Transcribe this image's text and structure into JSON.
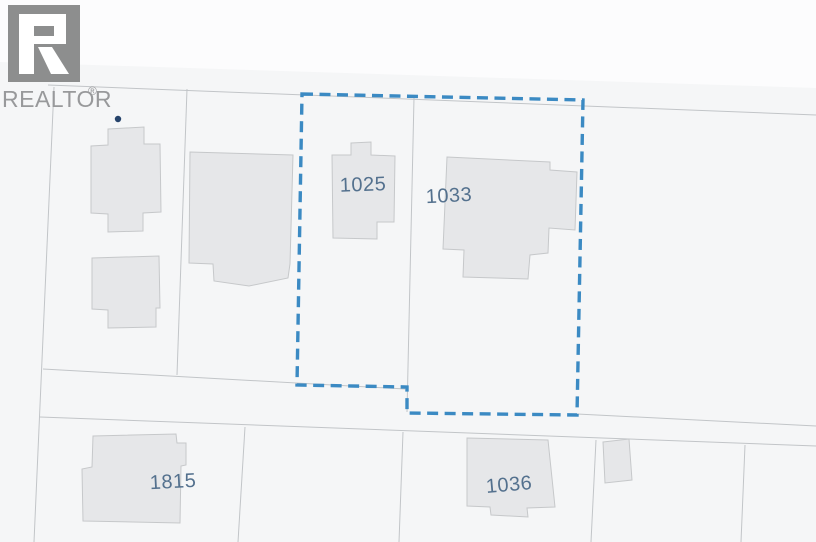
{
  "branding": {
    "logo_text": "REALTOR",
    "registered_mark": "®"
  },
  "colors": {
    "page_background": "#f5f6f7",
    "upper_band": "#fcfcfd",
    "building_fill": "#e6e7e9",
    "building_stroke": "#c6c8ca",
    "parcel_line": "#c2c5c8",
    "subject_boundary": "#3b8ac3",
    "parcel_label": "#54718e",
    "marker_dot": "#26436b",
    "logo_gray": "#8d8e8e",
    "logo_text_gray": "#98999b"
  },
  "parcels": {
    "labels": [
      {
        "name": "1025"
      },
      {
        "name": "1033"
      },
      {
        "name": "1815"
      },
      {
        "name": "1036"
      }
    ]
  }
}
